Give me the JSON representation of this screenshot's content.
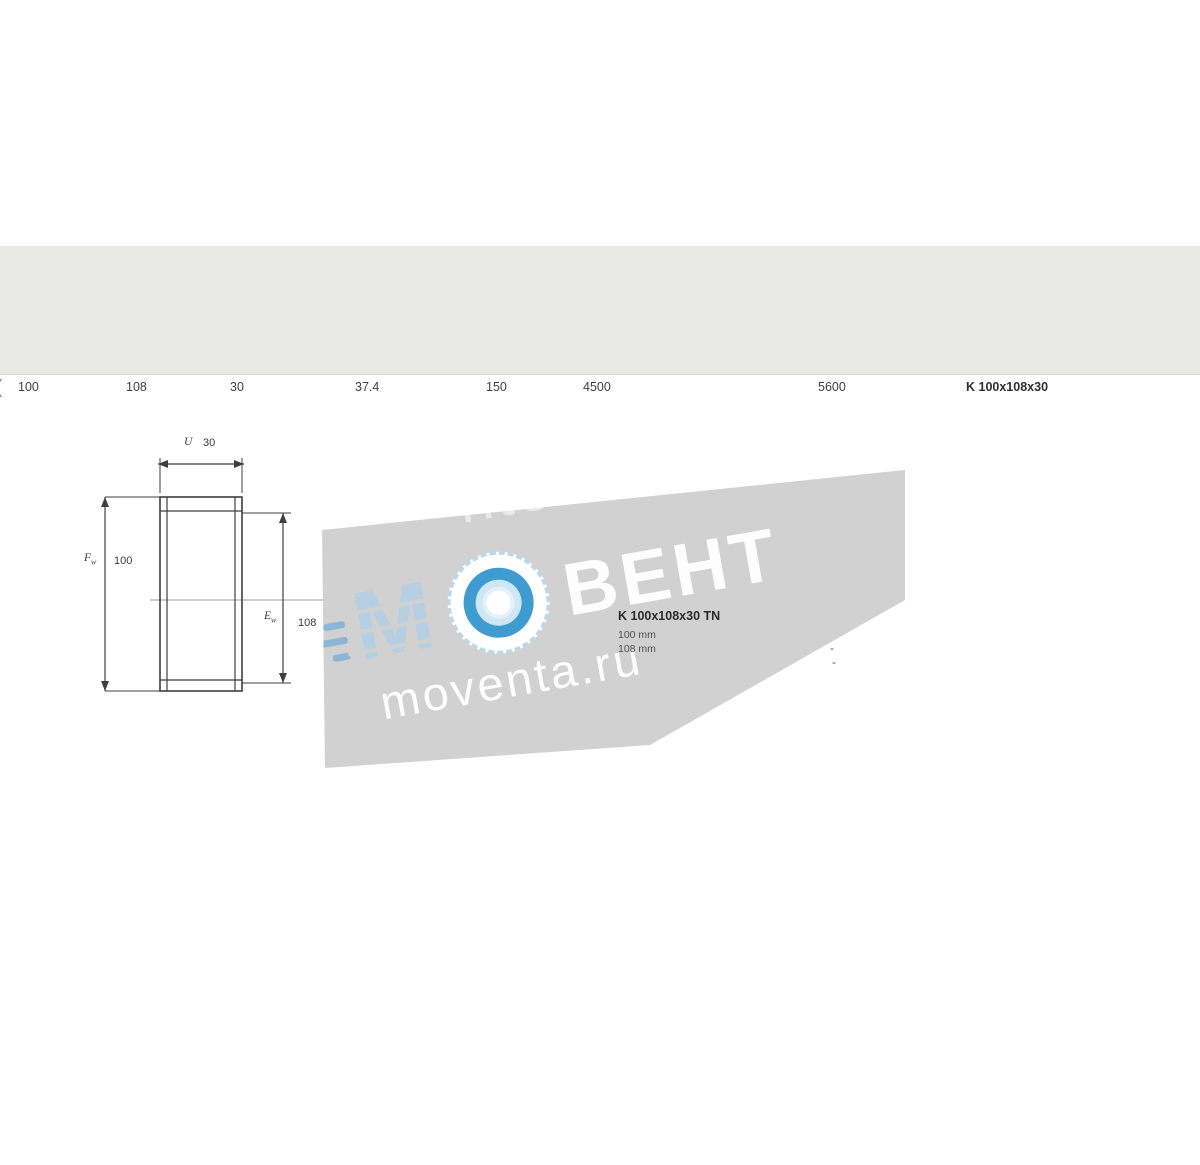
{
  "table": {
    "group_headers": {
      "dimensions": "Dimensions d'encombrement",
      "loads": "Charges de base",
      "speeds": "Vitesses de base",
      "designation": "Désignation"
    },
    "sub_headers": {
      "dynamic": "dynamique",
      "static": "statique",
      "ref_speed": "Vitesse de référence",
      "lim_speed": "Vitesse limite"
    },
    "symbols": {
      "fw_base": "F",
      "fw_sub": "w",
      "ew_base": "E",
      "ew_sub": "w",
      "u": "U",
      "c_base": "C",
      "c0_base": "C",
      "c0_sub": "0"
    },
    "units": {
      "dimensions": "mm",
      "loads": "kN",
      "ref_speed": "tr/min",
      "lim_speed": "tr/min",
      "designation": "-"
    },
    "row": {
      "fw": "100",
      "ew": "108",
      "u": "30",
      "c_dyn": "37.4",
      "c_stat": "150",
      "v_ref": "4500",
      "v_lim": "5600",
      "designation": "K 100x108x30"
    }
  },
  "drawing": {
    "dim_width_symbol": "U",
    "dim_width_value": "30",
    "dim_bore_symbol": "F",
    "dim_bore_sub": "w",
    "dim_bore_value": "100",
    "dim_outer_symbol": "E",
    "dim_outer_sub": "w",
    "dim_outer_value": "108",
    "caption_title": "K 100x108x30 TN",
    "caption_line_1": "100 mm",
    "caption_line_2": "108 mm",
    "dash_1": "-",
    "dash_2": "-"
  },
  "watermark": {
    "logo_letter": "M",
    "logo_text": "ВЕНТ",
    "site_url": "moventa.ru",
    "site_url_ghost": "nte.ru",
    "band_color": "#d1d1d1",
    "accent_blue": "#3f9cd0",
    "pale_blue": "#cfe6f5",
    "logo_letter_color": "#b7cfe2",
    "text_color": "#ffffff"
  },
  "artifacts": {
    "left_edge_mark": "("
  }
}
